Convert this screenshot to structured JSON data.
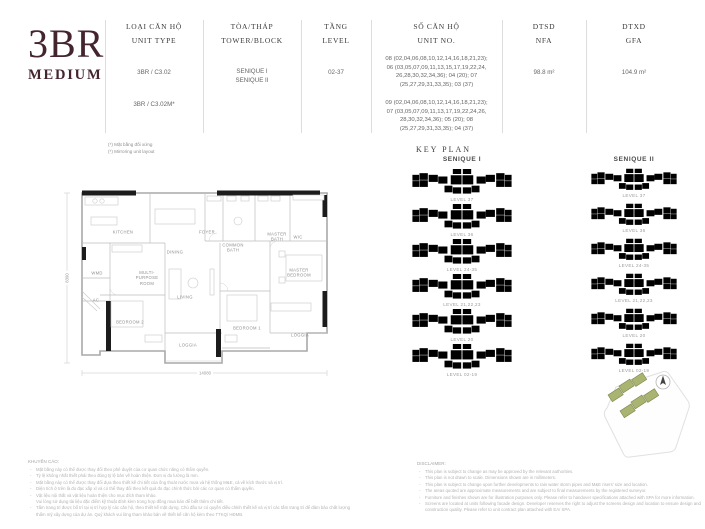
{
  "title": {
    "line1": "3BR",
    "line2": "MEDIUM"
  },
  "spec": {
    "unit_type": {
      "label_vi": "LOẠI CĂN HỘ",
      "label_en": "UNIT TYPE",
      "value1": "3BR / C3.02",
      "value2": "3BR / C3.02M*"
    },
    "tower": {
      "label_vi": "TÒA/THÁP",
      "label_en": "TOWER/BLOCK",
      "value": "SENIQUE I\nSENIQUE II"
    },
    "level": {
      "label_vi": "TẦNG",
      "label_en": "LEVEL",
      "value": "02-37"
    },
    "unit_no": {
      "label_vi": "SỐ CĂN HỘ",
      "label_en": "UNIT NO.",
      "value1": "08 (02,04,06,08,10,12,14,16,18,21,23);\n06 (03,05,07,09,11,13,15,17,19,22,24,\n26,28,30,32,34,36); 04 (20); 07\n(25,27,29,31,33,35); 03 (37)",
      "value2": "09 (02,04,06,08,10,12,14,16,18,21,23);\n07 (03,05,07,09,11,13,17,19,22,24,26,\n28,30,32,34,36); 05 (20); 08\n(25,27,29,31,33,35); 04 (37)"
    },
    "nfa": {
      "label_vi": "DTSD",
      "label_en": "NFA",
      "value": "98.8 m²"
    },
    "gfa": {
      "label_vi": "DTXD",
      "label_en": "GFA",
      "value": "104.9 m²"
    },
    "footnote_vi": "(*) Mặt bằng đối xứng",
    "footnote_en": "(*) Mirroring unit layout"
  },
  "floor_plan": {
    "rooms": {
      "kitchen": "KITCHEN",
      "dining": "DINING",
      "foyer": "FOYER",
      "common_bath": "COMMON\nBATH",
      "master_bath": "MASTER\nBATH",
      "wic": "WIC",
      "master_bedroom": "MASTER\nBEDROOM",
      "multi_purpose": "MULTI-\nPURPOSE\nROOM",
      "living": "LIVING",
      "wmd": "WMD",
      "ac": "AC",
      "bedroom2": "BEDROOM 2",
      "bedroom1": "BEDROOM 1",
      "loggia1": "LOGGIA",
      "loggia2": "LOGGIA"
    },
    "dim_width": "14080",
    "dim_height": "8390"
  },
  "key_plan": {
    "title": "KEY PLAN",
    "towers": [
      "SENIQUE I",
      "SENIQUE II"
    ],
    "levels": [
      "LEVEL 37",
      "LEVEL 36",
      "LEVEL 24-35",
      "LEVEL 21,22,23",
      "LEVEL 20",
      "LEVEL 02-19"
    ]
  },
  "footer": {
    "vi_title": "KHUYẾN CÁO:",
    "vi_lines": [
      "Mặt bằng này có thể được thay đổi theo phê duyệt của cơ quan chức năng có thẩm quyền.",
      "Tỷ lệ không nhất thiết phải theo đúng tỷ lệ bản vẽ hoàn thiện. Đơn vị đo lường là mm.",
      "Mặt bằng này có thể được thay đổi dựa theo thiết kế chi tiết của ống thoát nước mưa và hệ thống M&E, cả về kích thước và vị trí.",
      "Diện tích ở trên là đo đạc xấp xỉ và có thể thay đổi theo kết quả đo đạc chính thức bởi các cơ quan có thẩm quyền.",
      "Vật liệu nội thất và vật liệu hoàn thiện cho mục đích tham khảo.\nVui lòng sử dụng tài liệu đặc điểm kỹ thuật đính kèm trong hợp đồng mua bán để biết thêm chi tiết.",
      "Tấm trang trí được bố trí tại vị trí hợp lý các căn hộ, theo thiết kế mặt dựng. Chủ đầu tư có quyền điều chỉnh thiết kế và vị trí các tấm trang trí để đảm bảo chất lượng thẩm mỹ xây dựng của dự án. Quý khách vui lòng tham khảo bản vẽ thiết kế căn hộ kèm theo TTKQ/ HĐMB."
    ],
    "en_title": "DISCLAIMER:",
    "en_lines": [
      "This plan is subject to change as may be approved by the relevant authorities.",
      "This plan is not drawn to scale. Dimensions shown are in millimeters.",
      "This plan is subject to change upon further developments to rain water storm pipes and M&E risers' size and location.",
      "The areas quoted are approximate measurements and are subject to final measurements by the registered surveyor.",
      "Furniture and finishes shown are for illustration purposes only. Please refer to handover specifications attached with SPA for more information.",
      "Screens are located at units following facade design. Developer reserves the right to adjust the screens design and location to ensure design and construction quality. Please refer to unit contract plan attached with EA/ SPA."
    ]
  },
  "colors": {
    "accent": "#44252e",
    "key_plan_highlight": "#b7bd8c"
  }
}
